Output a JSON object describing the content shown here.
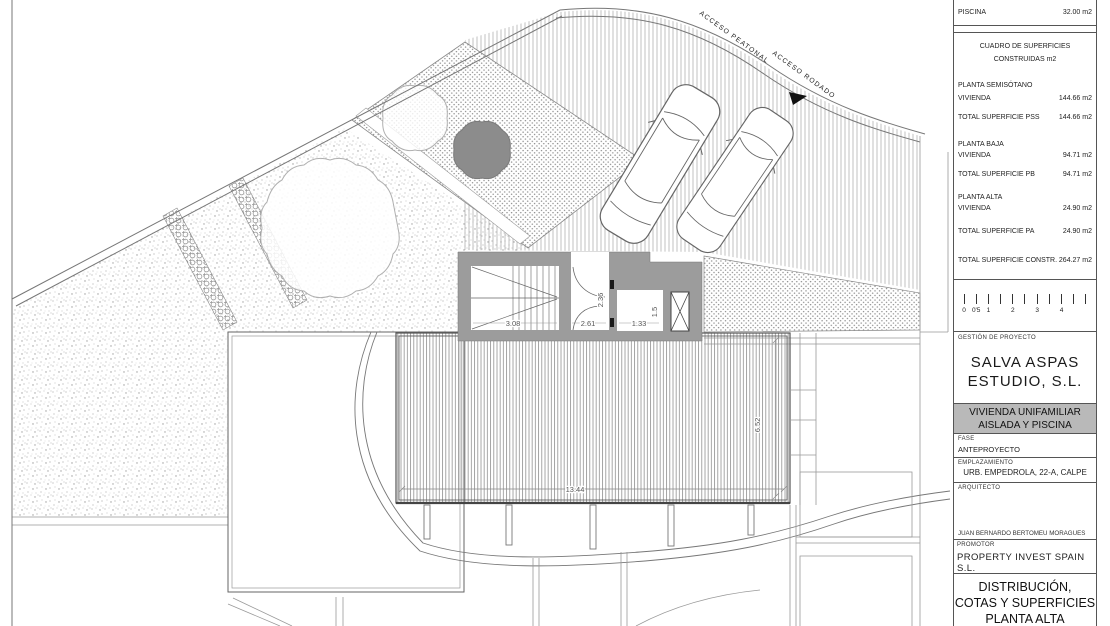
{
  "plan": {
    "labels": {
      "acceso_peatonal": "ACCESO PEATONAL",
      "acceso_rodado": "ACCESO RODADO"
    },
    "dims": {
      "stair": "3.08",
      "hall_w": "2.61",
      "hall_h": "2.36",
      "lobby_w": "1.33",
      "lobby_h": "1.5",
      "room_w": "13.44",
      "room_h": "6.52"
    }
  },
  "titleblock": {
    "piscina": {
      "label": "PISCINA",
      "value": "32.00 m2"
    },
    "surfaces": {
      "title1": "CUADRO DE SUPERFICIES",
      "title2": "CONSTRUIDAS m2",
      "rows": [
        {
          "label": "PLANTA SEMISÓTANO",
          "value": ""
        },
        {
          "label": "VIVIENDA",
          "value": "144.66 m2"
        },
        {
          "label": "TOTAL SUPERFICIE PSS",
          "value": "144.66 m2"
        },
        {
          "label": "PLANTA BAJA",
          "value": ""
        },
        {
          "label": "VIVIENDA",
          "value": "94.71 m2"
        },
        {
          "label": "TOTAL SUPERFICIE PB",
          "value": "94.71 m2"
        },
        {
          "label": "PLANTA ALTA",
          "value": ""
        },
        {
          "label": "VIVIENDA",
          "value": "24.90 m2"
        },
        {
          "label": "TOTAL SUPERFICIE PA",
          "value": "24.90 m2"
        },
        {
          "label": "TOTAL SUPERFICIE CONSTR.",
          "value": "264.27 m2"
        }
      ]
    },
    "scalebar": {
      "labels": [
        "0",
        "0'5",
        "1",
        "2",
        "3",
        "4"
      ]
    },
    "gestion": {
      "label": "GESTIÓN DE PROYECTO",
      "company_line1": "SALVA ASPAS",
      "company_line2": "ESTUDIO, S.L."
    },
    "project": {
      "line1": "VIVIENDA UNIFAMILIAR",
      "line2": "AISLADA Y PISCINA"
    },
    "fase": {
      "label": "FASE",
      "value": "ANTEPROYECTO"
    },
    "emplazamiento": {
      "label": "EMPLAZAMIENTO",
      "value": "URB. EMPEDROLA, 22-A, CALPE"
    },
    "arquitecto": {
      "label": "ARQUITECTO",
      "name": "JUAN BERNARDO BERTOMEU MORAGUES"
    },
    "promotor": {
      "label": "PROMOTOR",
      "value": "PROPERTY INVEST SPAIN S.L."
    },
    "drawing_title": {
      "line1": "DISTRIBUCIÓN,",
      "line2": "COTAS Y SUPERFICIES",
      "line3": "PLANTA ALTA"
    }
  }
}
